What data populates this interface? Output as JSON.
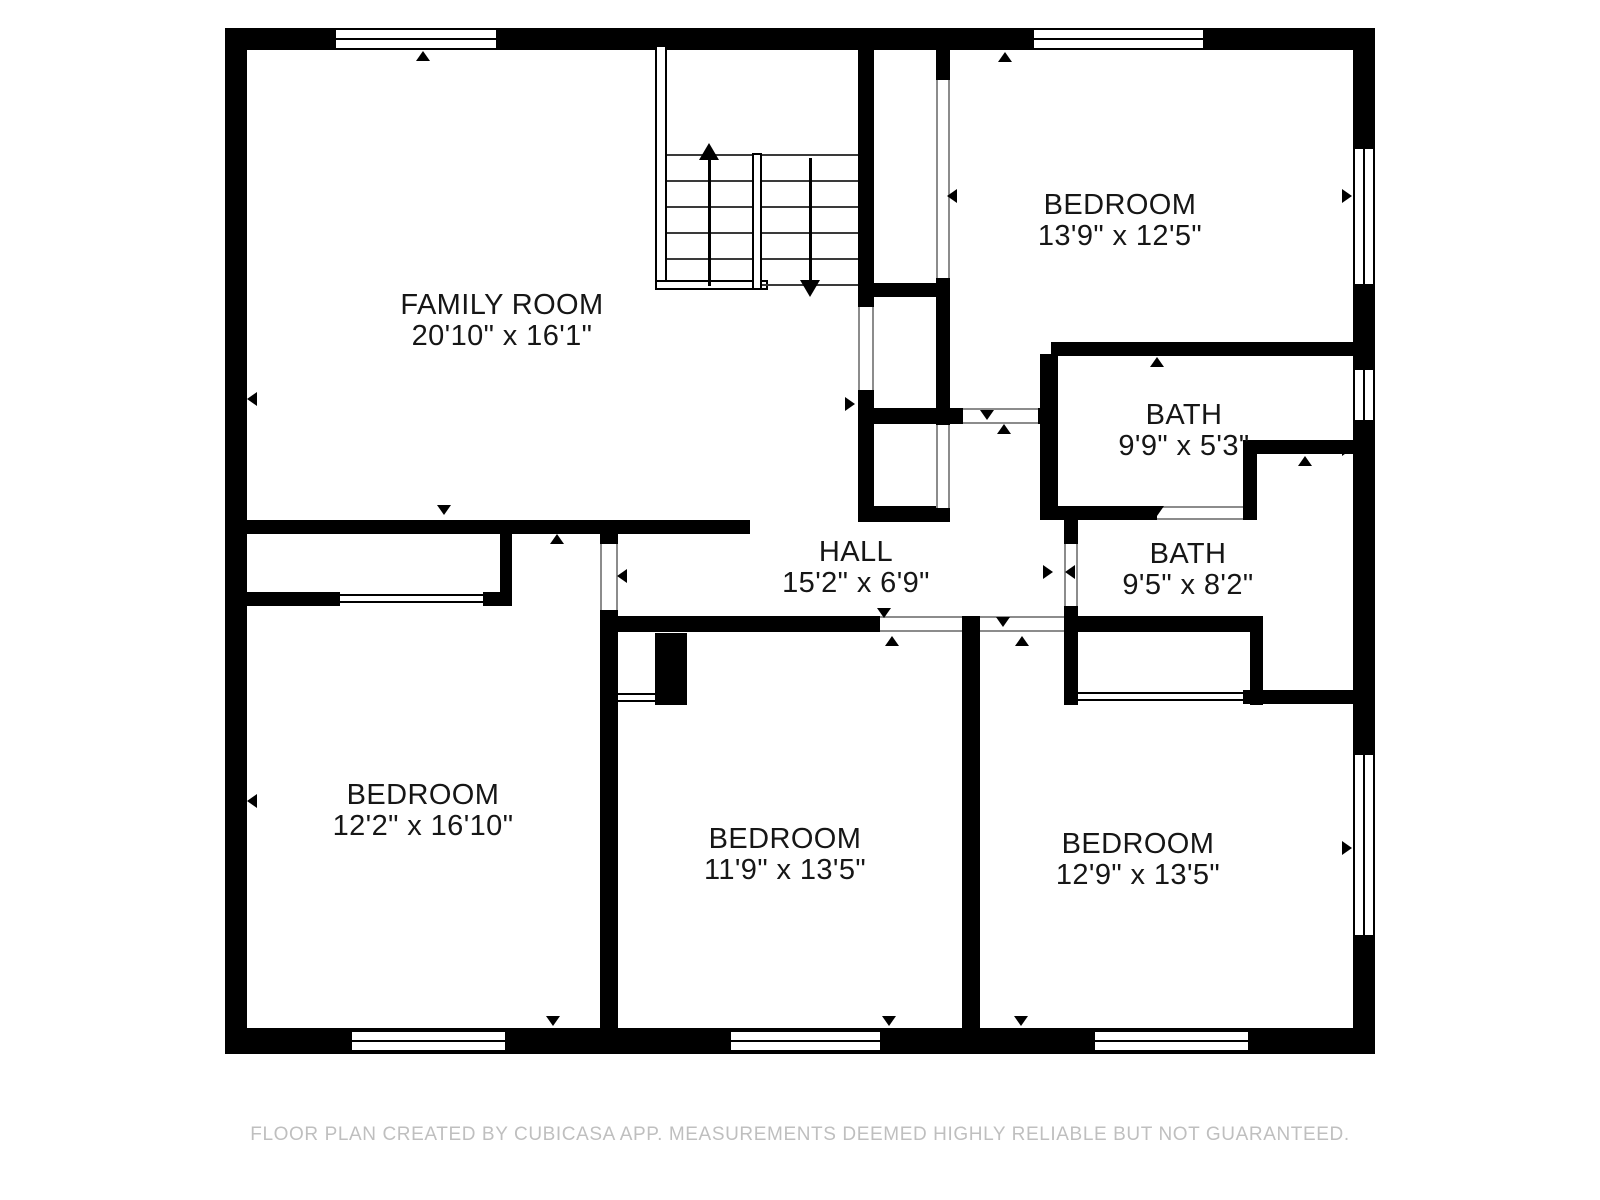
{
  "canvas": {
    "width": 1600,
    "height": 1200,
    "background": "#ffffff",
    "wall_color": "#000000",
    "opening_line_color": "#8c8c8c",
    "label_color": "#161616",
    "footer_color": "#bfbfbf"
  },
  "footer": {
    "text": "FLOOR PLAN CREATED BY CUBICASA APP. MEASUREMENTS DEEMED HIGHLY RELIABLE BUT NOT GUARANTEED."
  },
  "rooms": [
    {
      "id": "family-room",
      "name": "FAMILY ROOM",
      "dims": "20'10\" x 16'1\"",
      "cx": 502,
      "cy": 321
    },
    {
      "id": "bedroom-top-right",
      "name": "BEDROOM",
      "dims": "13'9\" x 12'5\"",
      "cx": 1120,
      "cy": 221
    },
    {
      "id": "bath-upper",
      "name": "BATH",
      "dims": "9'9\" x 5'3\"",
      "cx": 1184,
      "cy": 431
    },
    {
      "id": "bath-lower",
      "name": "BATH",
      "dims": "9'5\" x 8'2\"",
      "cx": 1188,
      "cy": 570
    },
    {
      "id": "hall",
      "name": "HALL",
      "dims": "15'2\" x 6'9\"",
      "cx": 856,
      "cy": 568
    },
    {
      "id": "bedroom-bottom-left",
      "name": "BEDROOM",
      "dims": "12'2\" x 16'10\"",
      "cx": 423,
      "cy": 811
    },
    {
      "id": "bedroom-bottom-middle",
      "name": "BEDROOM",
      "dims": "11'9\" x 13'5\"",
      "cx": 785,
      "cy": 855
    },
    {
      "id": "bedroom-bottom-right",
      "name": "BEDROOM",
      "dims": "12'9\" x 13'5\"",
      "cx": 1138,
      "cy": 860
    }
  ],
  "plan": {
    "walls": [
      {
        "x": 225,
        "y": 28,
        "w": 1150,
        "h": 22
      },
      {
        "x": 225,
        "y": 1028,
        "w": 1150,
        "h": 26
      },
      {
        "x": 225,
        "y": 28,
        "w": 22,
        "h": 1026
      },
      {
        "x": 1353,
        "y": 28,
        "w": 22,
        "h": 1026
      },
      {
        "x": 240,
        "y": 520,
        "w": 510,
        "h": 14
      },
      {
        "x": 500,
        "y": 520,
        "w": 12,
        "h": 86
      },
      {
        "x": 247,
        "y": 592,
        "w": 93,
        "h": 14
      },
      {
        "x": 483,
        "y": 592,
        "w": 29,
        "h": 14
      },
      {
        "x": 600,
        "y": 520,
        "w": 18,
        "h": 24
      },
      {
        "x": 600,
        "y": 610,
        "w": 18,
        "h": 418
      },
      {
        "x": 858,
        "y": 28,
        "w": 16,
        "h": 279
      },
      {
        "x": 858,
        "y": 390,
        "w": 16,
        "h": 132
      },
      {
        "x": 858,
        "y": 283,
        "w": 92,
        "h": 14
      },
      {
        "x": 936,
        "y": 50,
        "w": 14,
        "h": 30
      },
      {
        "x": 936,
        "y": 278,
        "w": 14,
        "h": 147
      },
      {
        "x": 858,
        "y": 408,
        "w": 105,
        "h": 16
      },
      {
        "x": 1038,
        "y": 408,
        "w": 20,
        "h": 16
      },
      {
        "x": 858,
        "y": 506,
        "w": 92,
        "h": 16
      },
      {
        "x": 1051,
        "y": 342,
        "w": 302,
        "h": 14
      },
      {
        "x": 1040,
        "y": 354,
        "w": 18,
        "h": 166
      },
      {
        "x": 1053,
        "y": 506,
        "w": 104,
        "h": 14
      },
      {
        "x": 1243,
        "y": 506,
        "w": 14,
        "h": 14
      },
      {
        "x": 1243,
        "y": 440,
        "w": 110,
        "h": 14
      },
      {
        "x": 1243,
        "y": 440,
        "w": 14,
        "h": 80
      },
      {
        "x": 1064,
        "y": 520,
        "w": 14,
        "h": 24
      },
      {
        "x": 1064,
        "y": 606,
        "w": 14,
        "h": 99
      },
      {
        "x": 618,
        "y": 616,
        "w": 262,
        "h": 16
      },
      {
        "x": 962,
        "y": 616,
        "w": 18,
        "h": 412
      },
      {
        "x": 1064,
        "y": 616,
        "w": 199,
        "h": 16
      },
      {
        "x": 1250,
        "y": 632,
        "w": 13,
        "h": 73
      },
      {
        "x": 1243,
        "y": 690,
        "w": 110,
        "h": 14
      },
      {
        "x": 655,
        "y": 633,
        "w": 32,
        "h": 72
      }
    ],
    "thin_walls": [
      {
        "x": 655,
        "y": 45,
        "w": 12,
        "h": 245
      },
      {
        "x": 655,
        "y": 280,
        "w": 113,
        "h": 10
      },
      {
        "x": 752,
        "y": 153,
        "w": 10,
        "h": 137
      }
    ],
    "windows": [
      {
        "x": 334,
        "y": 28,
        "w": 164,
        "h": 22,
        "o": "h"
      },
      {
        "x": 1032,
        "y": 28,
        "w": 173,
        "h": 22,
        "o": "h"
      },
      {
        "x": 1353,
        "y": 147,
        "w": 22,
        "h": 139,
        "o": "v"
      },
      {
        "x": 1353,
        "y": 368,
        "w": 22,
        "h": 54,
        "o": "v"
      },
      {
        "x": 1353,
        "y": 753,
        "w": 22,
        "h": 184,
        "o": "v"
      },
      {
        "x": 350,
        "y": 1030,
        "w": 157,
        "h": 22,
        "o": "h"
      },
      {
        "x": 729,
        "y": 1030,
        "w": 153,
        "h": 22,
        "o": "h"
      },
      {
        "x": 1093,
        "y": 1030,
        "w": 157,
        "h": 22,
        "o": "h"
      }
    ],
    "openings": [
      {
        "x": 600,
        "y": 544,
        "w": 18,
        "h": 66,
        "o": "v"
      },
      {
        "x": 936,
        "y": 80,
        "w": 14,
        "h": 198,
        "o": "v"
      },
      {
        "x": 858,
        "y": 307,
        "w": 16,
        "h": 83,
        "o": "v"
      },
      {
        "x": 936,
        "y": 425,
        "w": 14,
        "h": 83,
        "o": "v"
      },
      {
        "x": 963,
        "y": 408,
        "w": 75,
        "h": 16,
        "o": "h"
      },
      {
        "x": 1157,
        "y": 506,
        "w": 86,
        "h": 14,
        "o": "h"
      },
      {
        "x": 1064,
        "y": 544,
        "w": 14,
        "h": 62,
        "o": "v"
      },
      {
        "x": 880,
        "y": 616,
        "w": 82,
        "h": 16,
        "o": "h"
      },
      {
        "x": 980,
        "y": 616,
        "w": 84,
        "h": 16,
        "o": "h"
      }
    ],
    "sliding_doors": [
      {
        "x": 340,
        "y": 594,
        "w": 143,
        "h": 9
      },
      {
        "x": 618,
        "y": 693,
        "w": 37,
        "h": 9
      },
      {
        "x": 1078,
        "y": 692,
        "w": 165,
        "h": 9
      }
    ],
    "markers": [
      {
        "x": 423,
        "y": 56,
        "d": "up"
      },
      {
        "x": 1005,
        "y": 57,
        "d": "up"
      },
      {
        "x": 252,
        "y": 399,
        "d": "left"
      },
      {
        "x": 252,
        "y": 801,
        "d": "left"
      },
      {
        "x": 1347,
        "y": 196,
        "d": "right"
      },
      {
        "x": 1347,
        "y": 449,
        "d": "right"
      },
      {
        "x": 1347,
        "y": 848,
        "d": "right"
      },
      {
        "x": 444,
        "y": 510,
        "d": "down"
      },
      {
        "x": 557,
        "y": 539,
        "d": "up"
      },
      {
        "x": 952,
        "y": 196,
        "d": "left"
      },
      {
        "x": 850,
        "y": 404,
        "d": "right"
      },
      {
        "x": 987,
        "y": 415,
        "d": "down"
      },
      {
        "x": 1004,
        "y": 429,
        "d": "up"
      },
      {
        "x": 1157,
        "y": 362,
        "d": "up"
      },
      {
        "x": 1157,
        "y": 511,
        "d": "down"
      },
      {
        "x": 1048,
        "y": 572,
        "d": "right"
      },
      {
        "x": 1070,
        "y": 572,
        "d": "left"
      },
      {
        "x": 622,
        "y": 576,
        "d": "left"
      },
      {
        "x": 884,
        "y": 613,
        "d": "down"
      },
      {
        "x": 892,
        "y": 641,
        "d": "up"
      },
      {
        "x": 1003,
        "y": 622,
        "d": "down"
      },
      {
        "x": 1022,
        "y": 641,
        "d": "up"
      },
      {
        "x": 1307,
        "y": 695,
        "d": "down"
      },
      {
        "x": 1305,
        "y": 461,
        "d": "up"
      },
      {
        "x": 553,
        "y": 1021,
        "d": "down"
      },
      {
        "x": 889,
        "y": 1021,
        "d": "down"
      },
      {
        "x": 1021,
        "y": 1021,
        "d": "down"
      }
    ],
    "stairs": {
      "treads": [
        {
          "x1": 667,
          "x2": 752,
          "ys": [
            155,
            181,
            207,
            233,
            259
          ]
        },
        {
          "x1": 762,
          "x2": 858,
          "ys": [
            155,
            181,
            207,
            233,
            259,
            285
          ]
        }
      ],
      "arrows": [
        {
          "x": 709,
          "y1": 158,
          "y2": 286,
          "d": "up"
        },
        {
          "x": 810,
          "y1": 158,
          "y2": 282,
          "d": "down"
        }
      ]
    }
  }
}
